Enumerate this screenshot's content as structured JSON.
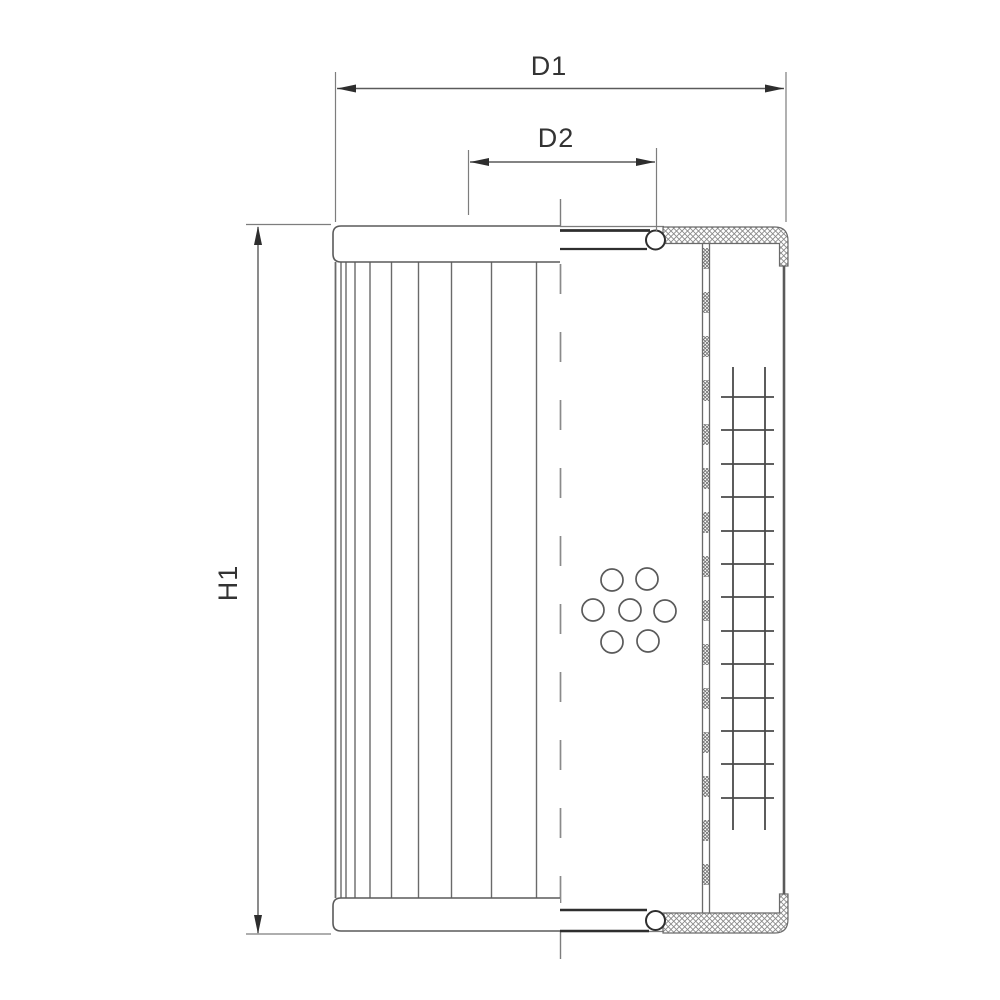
{
  "drawing": {
    "kind": "technical-drawing",
    "subject": "hydraulic-filter-element-half-section",
    "background": "#ffffff",
    "colors": {
      "line": "#5a5a5a",
      "light_line": "#7d7d7d",
      "dark_line": "#2e2e2e",
      "hatch": "#8a8a8a",
      "text": "#333333"
    },
    "dimensions": {
      "d1": {
        "label": "D1"
      },
      "d2": {
        "label": "D2"
      },
      "h1": {
        "label": "H1"
      }
    }
  }
}
